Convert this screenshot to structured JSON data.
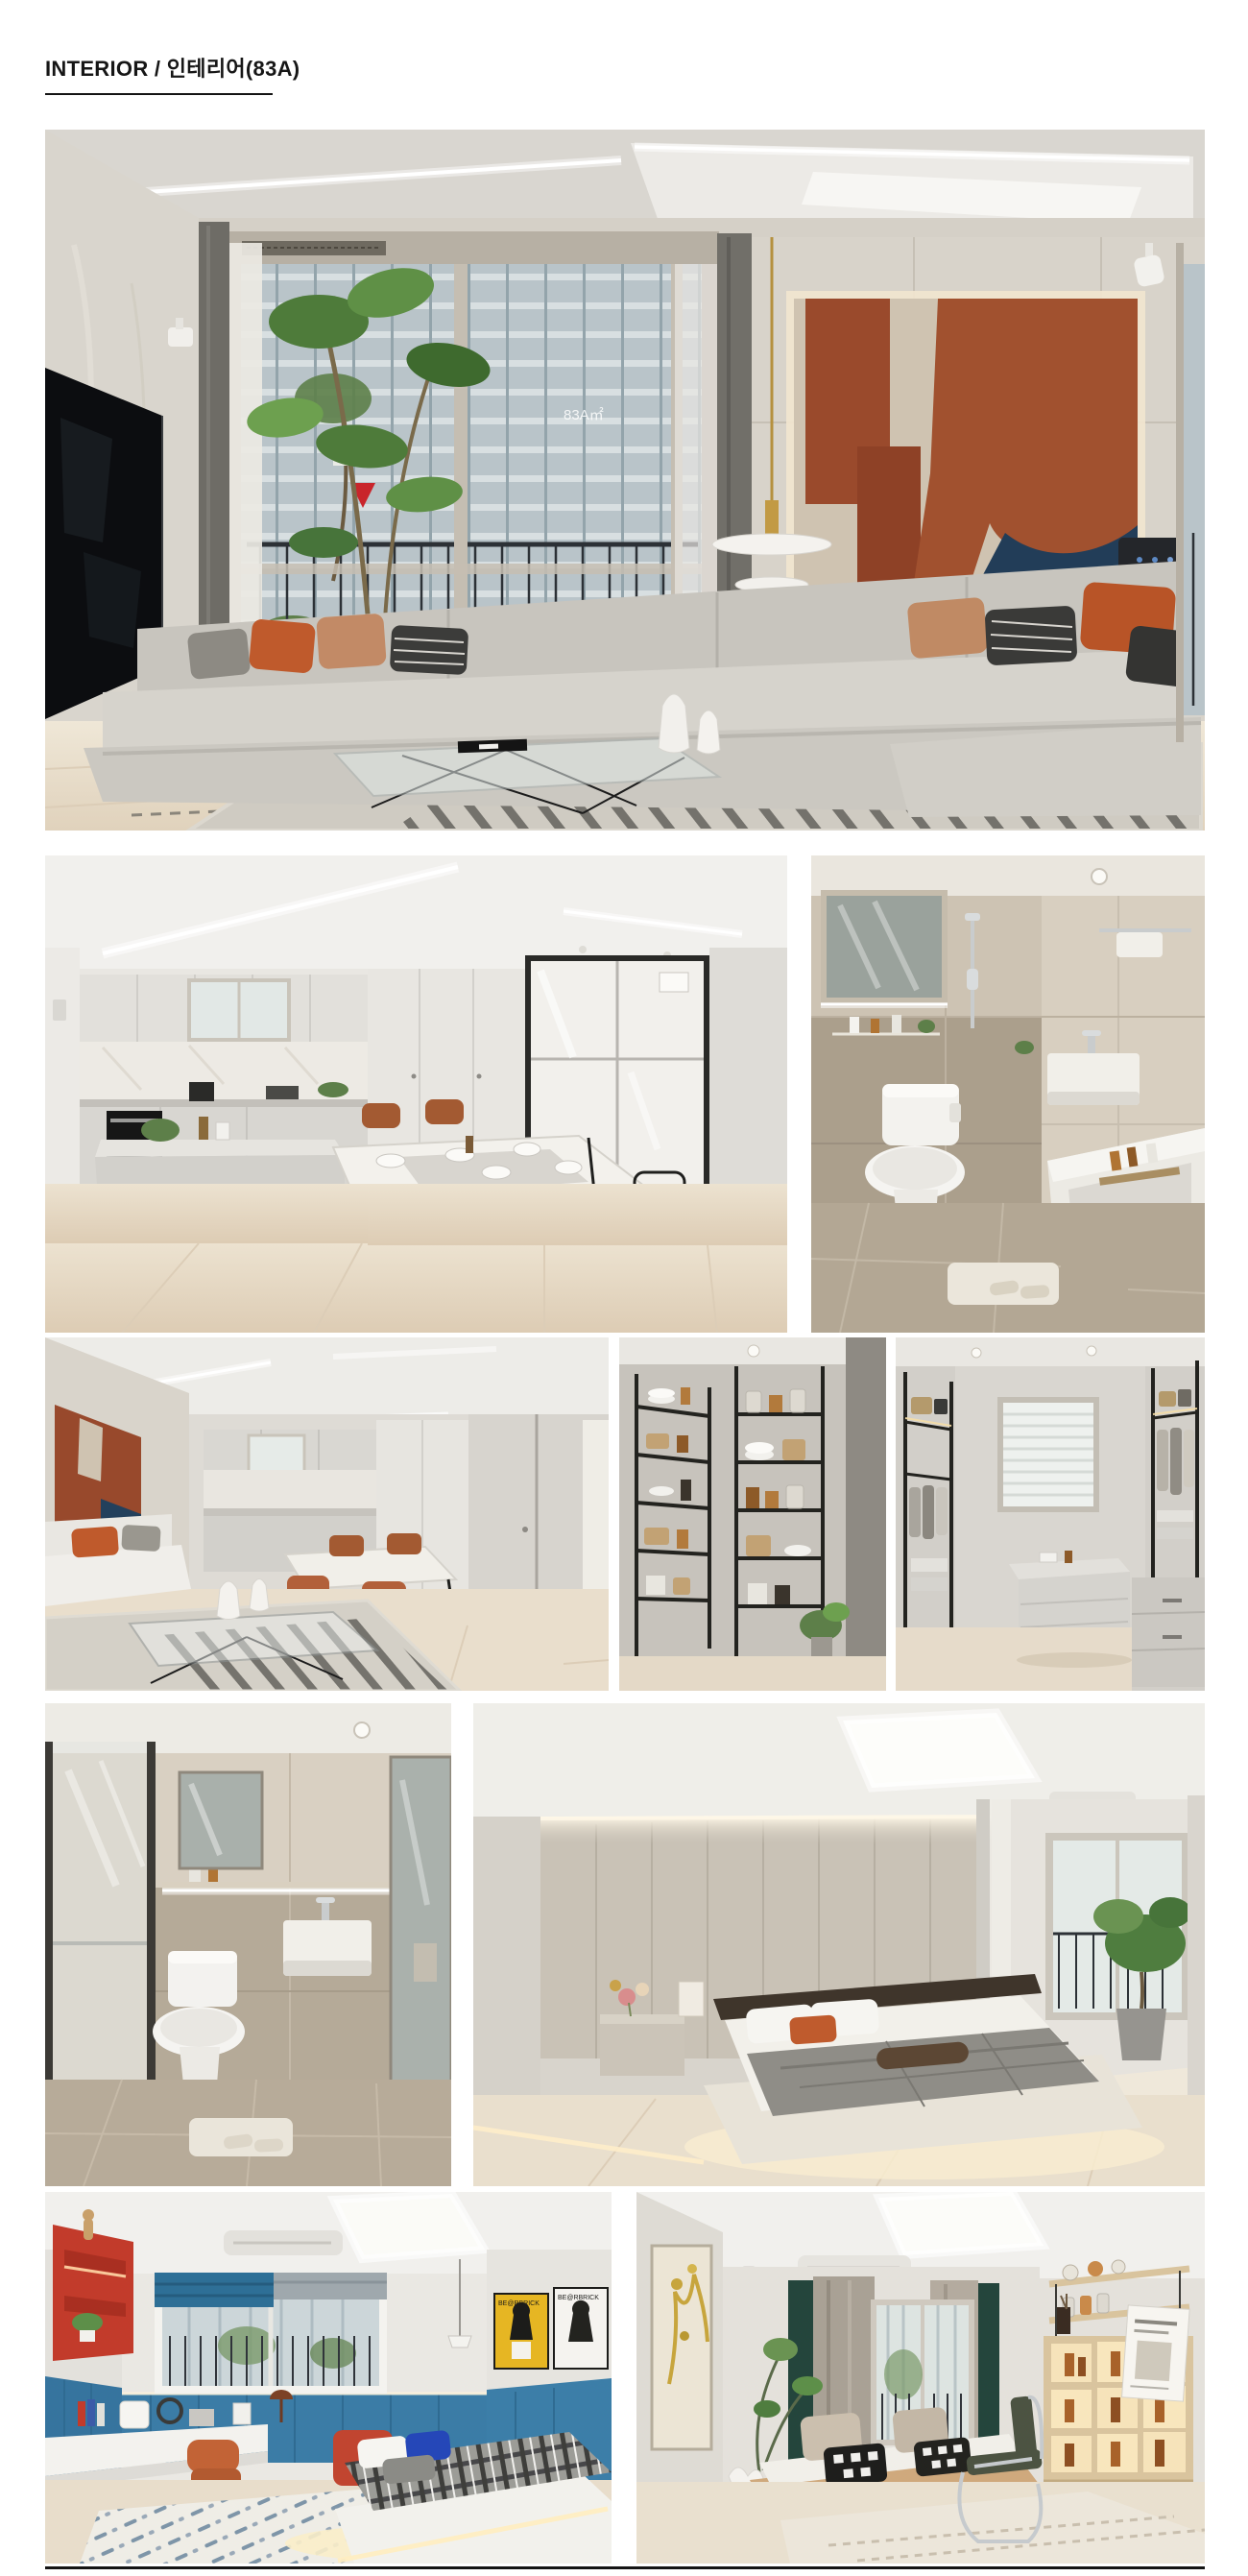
{
  "page": {
    "title": "INTERIOR / 인테리어(83A)"
  },
  "palette": {
    "accent_terracotta": "#9a4a2c",
    "accent_navy": "#223d58",
    "accent_orange": "#c05a2c",
    "kids_blue": "#3b7ca6",
    "kids_red": "#c23b2b",
    "wood_floor": "#e9dfcc",
    "wall_greige": "#d6d1c8",
    "rule_color": "#141414"
  },
  "gallery": {
    "window_decal": "83A㎡",
    "poster_text": "BE@RBRICK",
    "photos": [
      {
        "id": "living-room-main",
        "label": "Living room with window wall, backlit abstract artwork and long modular sofa"
      },
      {
        "id": "kitchen-dining",
        "label": "Kitchen with island, dining table and cognac leather chairs"
      },
      {
        "id": "bathroom-main",
        "label": "Main bathroom with mirror cabinet, toilet, wall-hung basin and bathtub"
      },
      {
        "id": "living-kitchen-view",
        "label": "Living room view toward kitchen and dining area"
      },
      {
        "id": "pantry",
        "label": "Pantry with black metal shelving, dishes, jars and baskets"
      },
      {
        "id": "dressing-room",
        "label": "Walk-in dressing room with island dresser and window"
      },
      {
        "id": "bathroom-guest",
        "label": "Guest bathroom with toilet, square basin and glass partition"
      },
      {
        "id": "bedroom-master",
        "label": "Master bedroom with padded headboard wall, floating bed and balcony plant room"
      },
      {
        "id": "kids-room",
        "label": "Kids room with blue wainscot, red shelf, desk and plaid bed"
      },
      {
        "id": "study-room",
        "label": "Study with daybed, chrome chair and lit display shelving"
      }
    ]
  }
}
